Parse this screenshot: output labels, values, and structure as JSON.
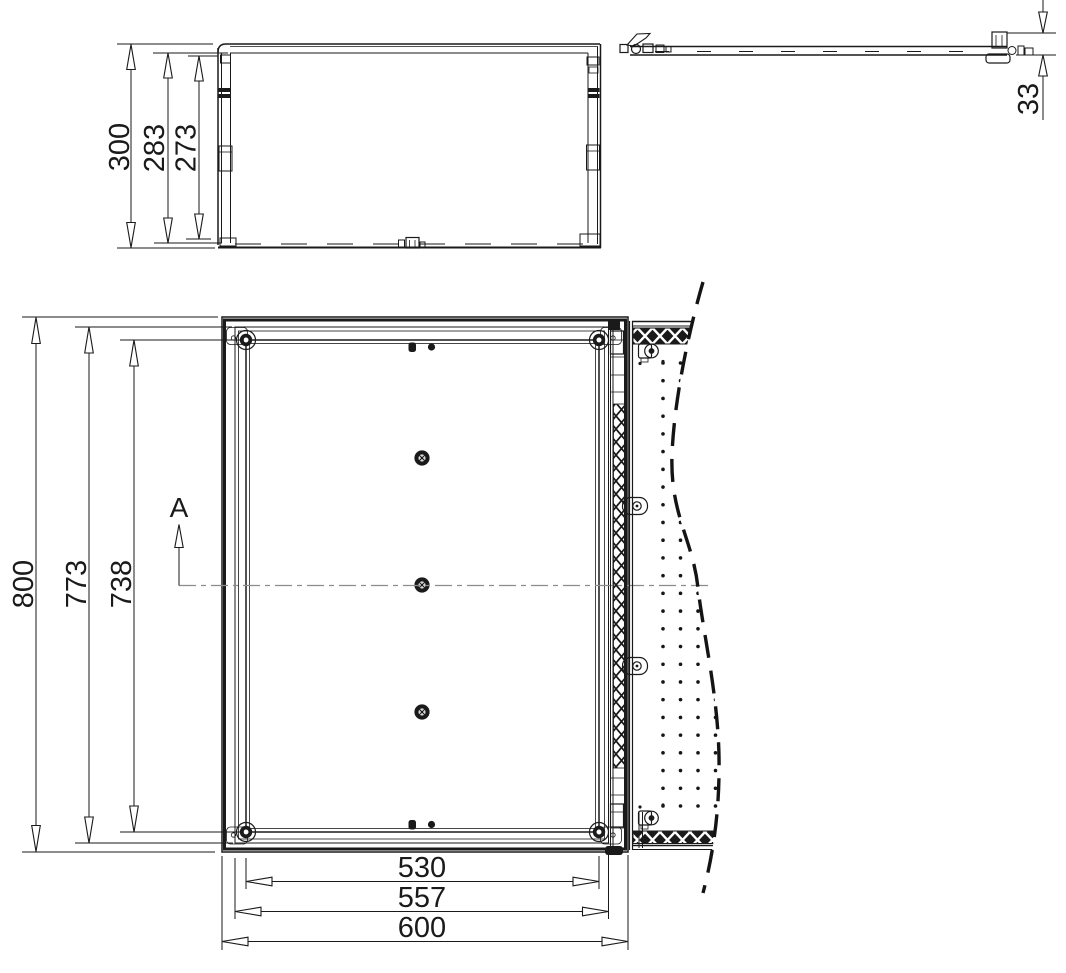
{
  "drawing": {
    "description": "enclosure technical drawing, two orthographic views with dimensions",
    "colors": {
      "ink": "#1a1a1a",
      "centerline": "#8c8c8c",
      "paper": "#ffffff",
      "break_line": "#141414"
    },
    "side_view": {
      "name": "top side-section view with door open",
      "dims": {
        "depth_total": "300",
        "depth_inner": "283",
        "depth_clear": "273",
        "door_thickness": "33"
      }
    },
    "front_view": {
      "name": "front view with door swung open",
      "section_label": "A",
      "dims": {
        "height_total": "800",
        "height_seal": "773",
        "height_plate": "738",
        "width_plate": "530",
        "width_seal": "557",
        "width_total": "600"
      }
    }
  }
}
